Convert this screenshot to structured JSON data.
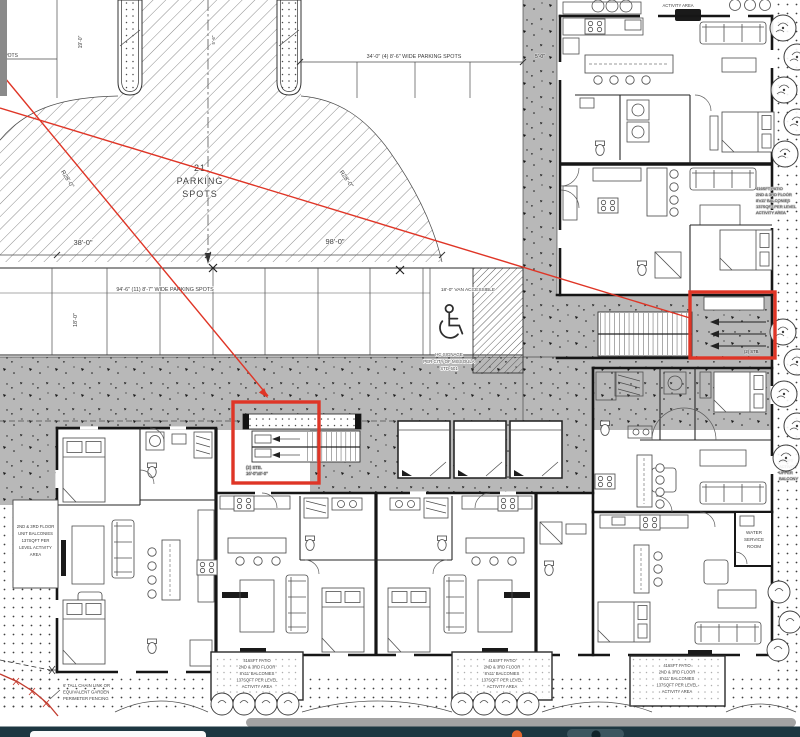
{
  "parking": {
    "spots": [
      "21",
      "PARKING",
      "SPOTS"
    ],
    "dim_top": "34'-0\" (4) 8'-6\" WIDE PARKING SPOTS",
    "dim_5": "5'-0\"",
    "cut_spots": "SPOTS",
    "dim_19": "19'-0\"",
    "dim_56": "5'-6\"",
    "r28_left": "R28'-0\"",
    "r28_right": "R28'-0\"",
    "dim_38": "38'-0\"",
    "dim_98": "98'-0\"",
    "dim_row": "94'-6\" (11) 8'-7\" WIDE PARKING SPOTS",
    "van": "18'-0\" VAN ACCESSIBLE",
    "dim_18": "18'-0\"",
    "hc": [
      "HC SIGNAGE",
      "PER CITY OF MISSOULA",
      "STD-501"
    ]
  },
  "stairs": {
    "left": [
      "(2) STB.",
      "16'-0\"x8'-0\""
    ],
    "right": "(2) STB."
  },
  "notes": {
    "patio": [
      "416SFT PATIO",
      "2ND & 3RD FLOOR",
      "8'x11' BALCONIES",
      "137SQFT PER LEVEL",
      "ACTIVITY AREA"
    ],
    "left_balc": [
      "2ND & 3RD FLOOR",
      "UNIT BALCONIES",
      "137SQFT PER",
      "LEVEL ACTIVITY",
      "AREA"
    ],
    "fence": [
      "6' TALL CHAIN LINK OR",
      "EQUIVALENT GARDEN",
      "PERIMETER FENCING"
    ],
    "water": [
      "WATER",
      "SERVICE",
      "ROOM"
    ],
    "act_top": "ACTIVITY AREA",
    "right_edge": [
      "345SFT",
      "ACTIVITY",
      "UPPER",
      "BALCONY"
    ]
  },
  "colors": {
    "annotation_red": "#df3526",
    "concrete_gray": "#b8b8b8",
    "taskbar": "#1d3741",
    "accent_orange": "#e4662e"
  }
}
